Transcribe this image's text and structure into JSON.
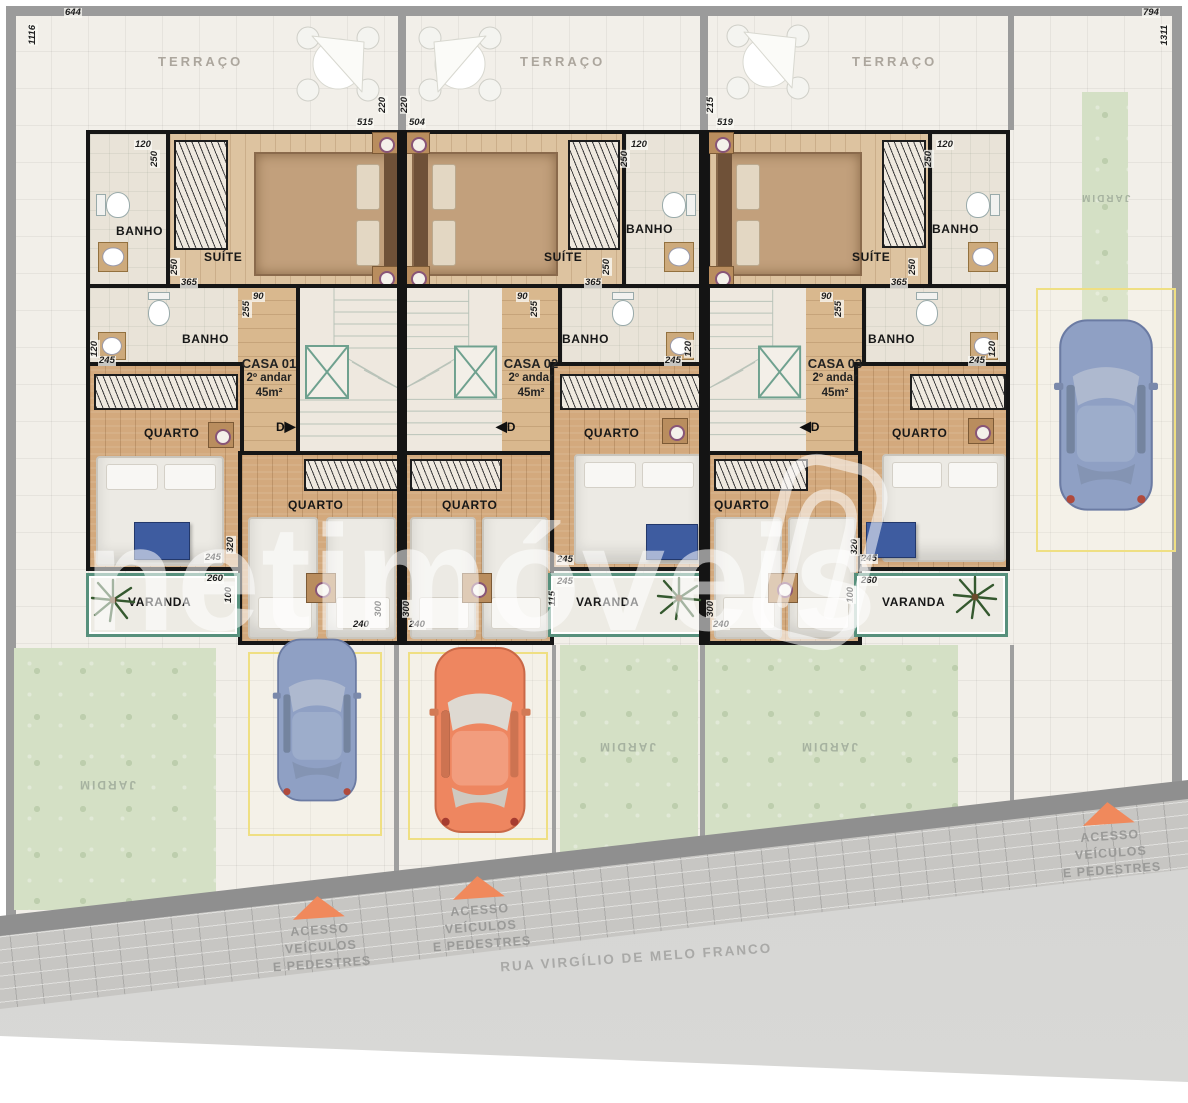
{
  "watermark": "netimóveis",
  "street": {
    "name": "RUA VIRGÍLIO DE MELO FRANCO"
  },
  "access": {
    "line1": "ACESSO",
    "line2": "VEÍCULOS",
    "line3": "E PEDESTRES"
  },
  "gardens": {
    "left": "JARDIM",
    "middle_left": "JARDIM",
    "middle_right": "JARDIM",
    "right_strip": "JARDIM"
  },
  "houses": [
    {
      "name": "CASA 01",
      "floor": "2º andar",
      "area": "45m²",
      "terrace": "TERRAÇO",
      "suite": "SUÍTE",
      "bath_top": "BANHO",
      "bath_mid": "BANHO",
      "bedroom_main": "QUARTO",
      "bedroom_second": "QUARTO",
      "balcony": "VARANDA",
      "door": "D"
    },
    {
      "name": "CASA 02",
      "floor": "2º andar",
      "area": "45m²",
      "terrace": "TERRAÇO",
      "suite": "SUÍTE",
      "bath_top": "BANHO",
      "bath_mid": "BANHO",
      "bedroom_main": "QUARTO",
      "bedroom_second": "QUARTO",
      "balcony": "VARANDA",
      "door": "D"
    },
    {
      "name": "CASA 03",
      "floor": "2º andar",
      "area": "45m²",
      "terrace": "TERRAÇO",
      "suite": "SUÍTE",
      "bath_top": "BANHO",
      "bath_mid": "BANHO",
      "bedroom_main": "QUARTO",
      "bedroom_second": "QUARTO",
      "balcony": "VARANDA",
      "door": "D"
    }
  ],
  "dims": [
    "644",
    "1116",
    "794",
    "1311",
    "220",
    "515",
    "220",
    "504",
    "215",
    "519",
    "120",
    "250",
    "250",
    "365",
    "120",
    "250",
    "250",
    "365",
    "120",
    "250",
    "250",
    "365",
    "90",
    "255",
    "90",
    "255",
    "90",
    "255",
    "120",
    "245",
    "245",
    "120",
    "245",
    "120",
    "320",
    "245",
    "260",
    "100",
    "300",
    "240",
    "300",
    "240",
    "245",
    "245",
    "115",
    "300",
    "240",
    "320",
    "245",
    "260",
    "100"
  ]
}
